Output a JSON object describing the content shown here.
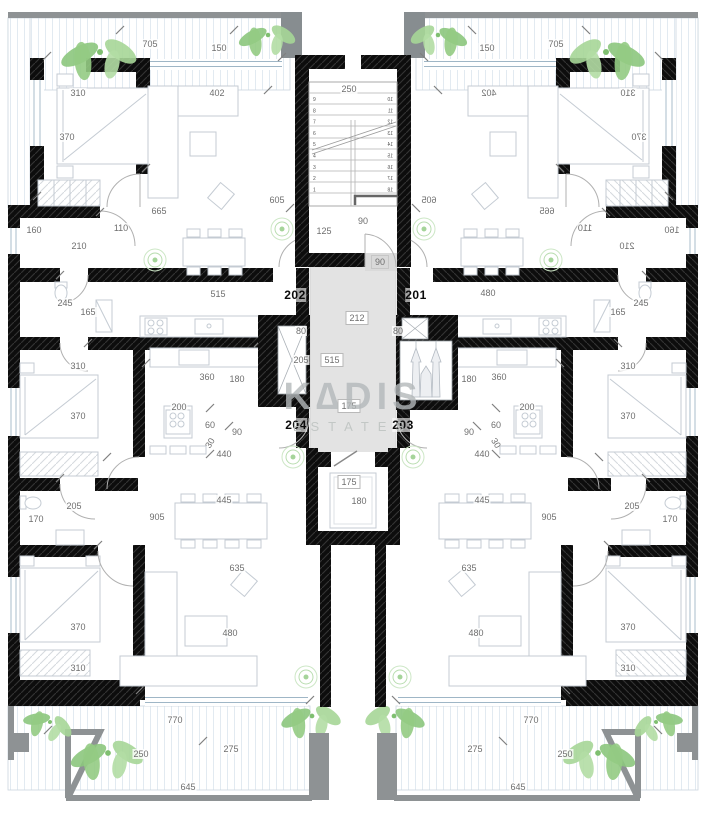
{
  "watermark": {
    "line1": "K∆DIS",
    "line2": "ESTATES"
  },
  "apartments": [
    {
      "id": "202",
      "x": 295,
      "y": 295
    },
    {
      "id": "201",
      "x": 416,
      "y": 295
    },
    {
      "id": "204",
      "x": 296,
      "y": 425
    },
    {
      "id": "203",
      "x": 403,
      "y": 425
    }
  ],
  "stairs": {
    "left_numbers": [
      "9",
      "8",
      "7",
      "6",
      "5",
      "4",
      "3",
      "2",
      "1"
    ],
    "right_numbers": [
      "10",
      "11",
      "12",
      "13",
      "14",
      "15",
      "16",
      "17",
      "18"
    ]
  },
  "dimensions": [
    {
      "t": "705",
      "x": 150,
      "y": 44
    },
    {
      "t": "150",
      "x": 219,
      "y": 48
    },
    {
      "t": "310",
      "x": 78,
      "y": 93
    },
    {
      "t": "402",
      "x": 217,
      "y": 93
    },
    {
      "t": "370",
      "x": 67,
      "y": 137
    },
    {
      "t": "605",
      "x": 277,
      "y": 200
    },
    {
      "t": "665",
      "x": 159,
      "y": 211
    },
    {
      "t": "110",
      "x": 121,
      "y": 228
    },
    {
      "t": "160",
      "x": 34,
      "y": 230
    },
    {
      "t": "210",
      "x": 79,
      "y": 246
    },
    {
      "t": "245",
      "x": 65,
      "y": 303
    },
    {
      "t": "165",
      "x": 88,
      "y": 312
    },
    {
      "t": "515",
      "x": 218,
      "y": 294
    },
    {
      "t": "310",
      "x": 78,
      "y": 366
    },
    {
      "t": "360",
      "x": 207,
      "y": 377
    },
    {
      "t": "180",
      "x": 237,
      "y": 379
    },
    {
      "t": "200",
      "x": 179,
      "y": 407
    },
    {
      "t": "370",
      "x": 78,
      "y": 416
    },
    {
      "t": "60",
      "x": 210,
      "y": 425
    },
    {
      "t": "90",
      "x": 237,
      "y": 432
    },
    {
      "t": "30",
      "x": 210,
      "y": 443,
      "rot": -58
    },
    {
      "t": "440",
      "x": 224,
      "y": 454
    },
    {
      "t": "445",
      "x": 224,
      "y": 500
    },
    {
      "t": "905",
      "x": 157,
      "y": 517
    },
    {
      "t": "205",
      "x": 74,
      "y": 506
    },
    {
      "t": "170",
      "x": 36,
      "y": 519
    },
    {
      "t": "635",
      "x": 237,
      "y": 568
    },
    {
      "t": "370",
      "x": 78,
      "y": 627
    },
    {
      "t": "480",
      "x": 230,
      "y": 633
    },
    {
      "t": "310",
      "x": 78,
      "y": 668
    },
    {
      "t": "770",
      "x": 175,
      "y": 720
    },
    {
      "t": "250",
      "x": 141,
      "y": 754
    },
    {
      "t": "275",
      "x": 231,
      "y": 749
    },
    {
      "t": "645",
      "x": 188,
      "y": 787
    },
    {
      "t": "250",
      "x": 349,
      "y": 89
    },
    {
      "t": "90",
      "x": 363,
      "y": 221
    },
    {
      "t": "125",
      "x": 324,
      "y": 231
    },
    {
      "t": "90",
      "x": 380,
      "y": 262,
      "chip": "g"
    },
    {
      "t": "212",
      "x": 357,
      "y": 318,
      "chip": "w"
    },
    {
      "t": "80",
      "x": 301,
      "y": 331
    },
    {
      "t": "80",
      "x": 398,
      "y": 331
    },
    {
      "t": "205",
      "x": 301,
      "y": 360
    },
    {
      "t": "515",
      "x": 332,
      "y": 360,
      "chip": "w"
    },
    {
      "t": "175",
      "x": 349,
      "y": 406,
      "chip": "w"
    },
    {
      "t": "175",
      "x": 349,
      "y": 482,
      "chip": "w"
    },
    {
      "t": "180",
      "x": 359,
      "y": 501
    },
    {
      "t": "310",
      "x": 628,
      "y": 93,
      "m": true
    },
    {
      "t": "402",
      "x": 489,
      "y": 93,
      "m": true
    },
    {
      "t": "370",
      "x": 639,
      "y": 137,
      "m": true
    },
    {
      "t": "605",
      "x": 429,
      "y": 200,
      "m": true
    },
    {
      "t": "665",
      "x": 547,
      "y": 211,
      "m": true
    },
    {
      "t": "110",
      "x": 585,
      "y": 228,
      "m": true
    },
    {
      "t": "160",
      "x": 672,
      "y": 230,
      "m": true
    },
    {
      "t": "210",
      "x": 627,
      "y": 246,
      "m": true
    },
    {
      "t": "150",
      "x": 487,
      "y": 48
    },
    {
      "t": "705",
      "x": 556,
      "y": 44
    },
    {
      "t": "245",
      "x": 641,
      "y": 303
    },
    {
      "t": "165",
      "x": 618,
      "y": 312
    },
    {
      "t": "480",
      "x": 488,
      "y": 293
    },
    {
      "t": "310",
      "x": 628,
      "y": 366
    },
    {
      "t": "360",
      "x": 499,
      "y": 377
    },
    {
      "t": "180",
      "x": 469,
      "y": 379
    },
    {
      "t": "200",
      "x": 527,
      "y": 407
    },
    {
      "t": "370",
      "x": 628,
      "y": 416
    },
    {
      "t": "60",
      "x": 496,
      "y": 425
    },
    {
      "t": "90",
      "x": 469,
      "y": 432
    },
    {
      "t": "30",
      "x": 496,
      "y": 443,
      "rot": 58
    },
    {
      "t": "440",
      "x": 482,
      "y": 454
    },
    {
      "t": "445",
      "x": 482,
      "y": 500
    },
    {
      "t": "905",
      "x": 549,
      "y": 517
    },
    {
      "t": "205",
      "x": 632,
      "y": 506
    },
    {
      "t": "170",
      "x": 670,
      "y": 519
    },
    {
      "t": "635",
      "x": 469,
      "y": 568
    },
    {
      "t": "370",
      "x": 628,
      "y": 627
    },
    {
      "t": "480",
      "x": 476,
      "y": 633
    },
    {
      "t": "310",
      "x": 628,
      "y": 668
    },
    {
      "t": "770",
      "x": 531,
      "y": 720
    },
    {
      "t": "250",
      "x": 565,
      "y": 754
    },
    {
      "t": "275",
      "x": 475,
      "y": 749
    },
    {
      "t": "645",
      "x": 518,
      "y": 787
    }
  ],
  "colors": {
    "wall": "#0d0d0d",
    "parapet": "#8e9294",
    "corridor": "#e3e3e3",
    "furniture": "#c4cbd3",
    "plant": "#8cc67d",
    "dimension_text": "#6e6e6e",
    "watermark": "#b3b8ba"
  }
}
